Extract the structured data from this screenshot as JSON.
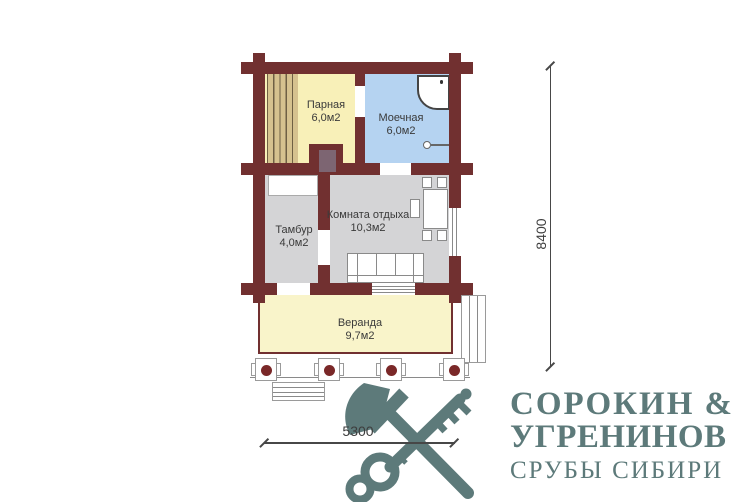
{
  "plan": {
    "rooms": [
      {
        "name": "Парная",
        "area": "6,0м2"
      },
      {
        "name": "Моечная",
        "area": "6,0м2"
      },
      {
        "name": "Тамбур",
        "area": "4,0м2"
      },
      {
        "name": "Комната отдыха",
        "area": "10,3м2"
      },
      {
        "name": "Веранда",
        "area": "9,7м2"
      }
    ],
    "dimensions": {
      "vertical": "8400",
      "horizontal": "5300"
    },
    "colors": {
      "wall": "#713030",
      "steam_room_floor": "#f8f0b8",
      "washing_room_floor": "#b5d3f1",
      "gray_floor": "#d4d4d6",
      "veranda_floor": "#f9f4ca",
      "bench_planks": "#d6c28f",
      "post": "#7a2828",
      "stove_door": "#7d6572",
      "logo": "#5d7a7a"
    }
  },
  "logo": {
    "icon": "crossed-axe-and-key",
    "name_line1": "СОРОКИН",
    "ampersand": "&",
    "name_line2": "УГРЕНИНОВ",
    "tagline": "СРУБЫ СИБИРИ"
  }
}
